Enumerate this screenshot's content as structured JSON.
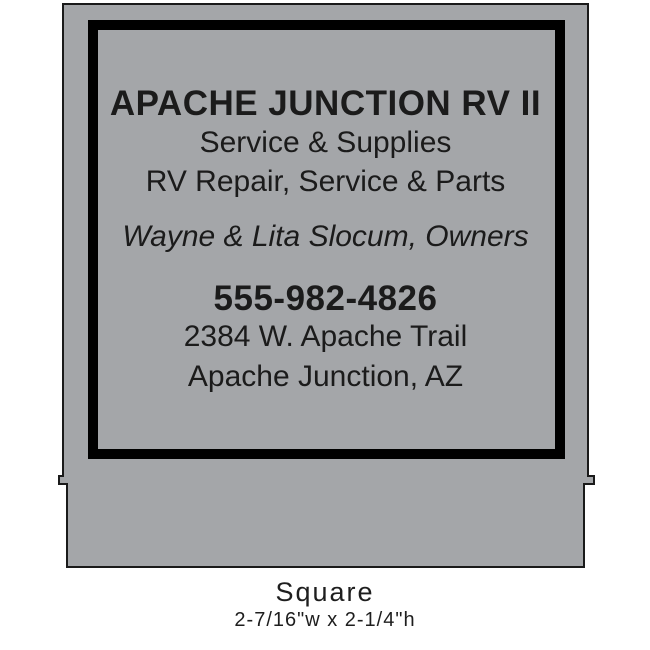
{
  "label": {
    "business_name": "APACHE JUNCTION RV II",
    "tagline1": "Service & Supplies",
    "tagline2": "RV Repair, Service & Parts",
    "owners": "Wayne & Lita Slocum, Owners",
    "phone": "555-982-4826",
    "address_line1": "2384 W. Apache Trail",
    "address_line2": "Apache Junction, AZ"
  },
  "caption": {
    "shape_name": "Square",
    "dimensions": "2-7/16\"w x 2-1/4\"h"
  },
  "colors": {
    "label_bg": "#a4a6a9",
    "outline": "#1a1a1a",
    "frame": "#000000",
    "text": "#1b1b1b"
  }
}
